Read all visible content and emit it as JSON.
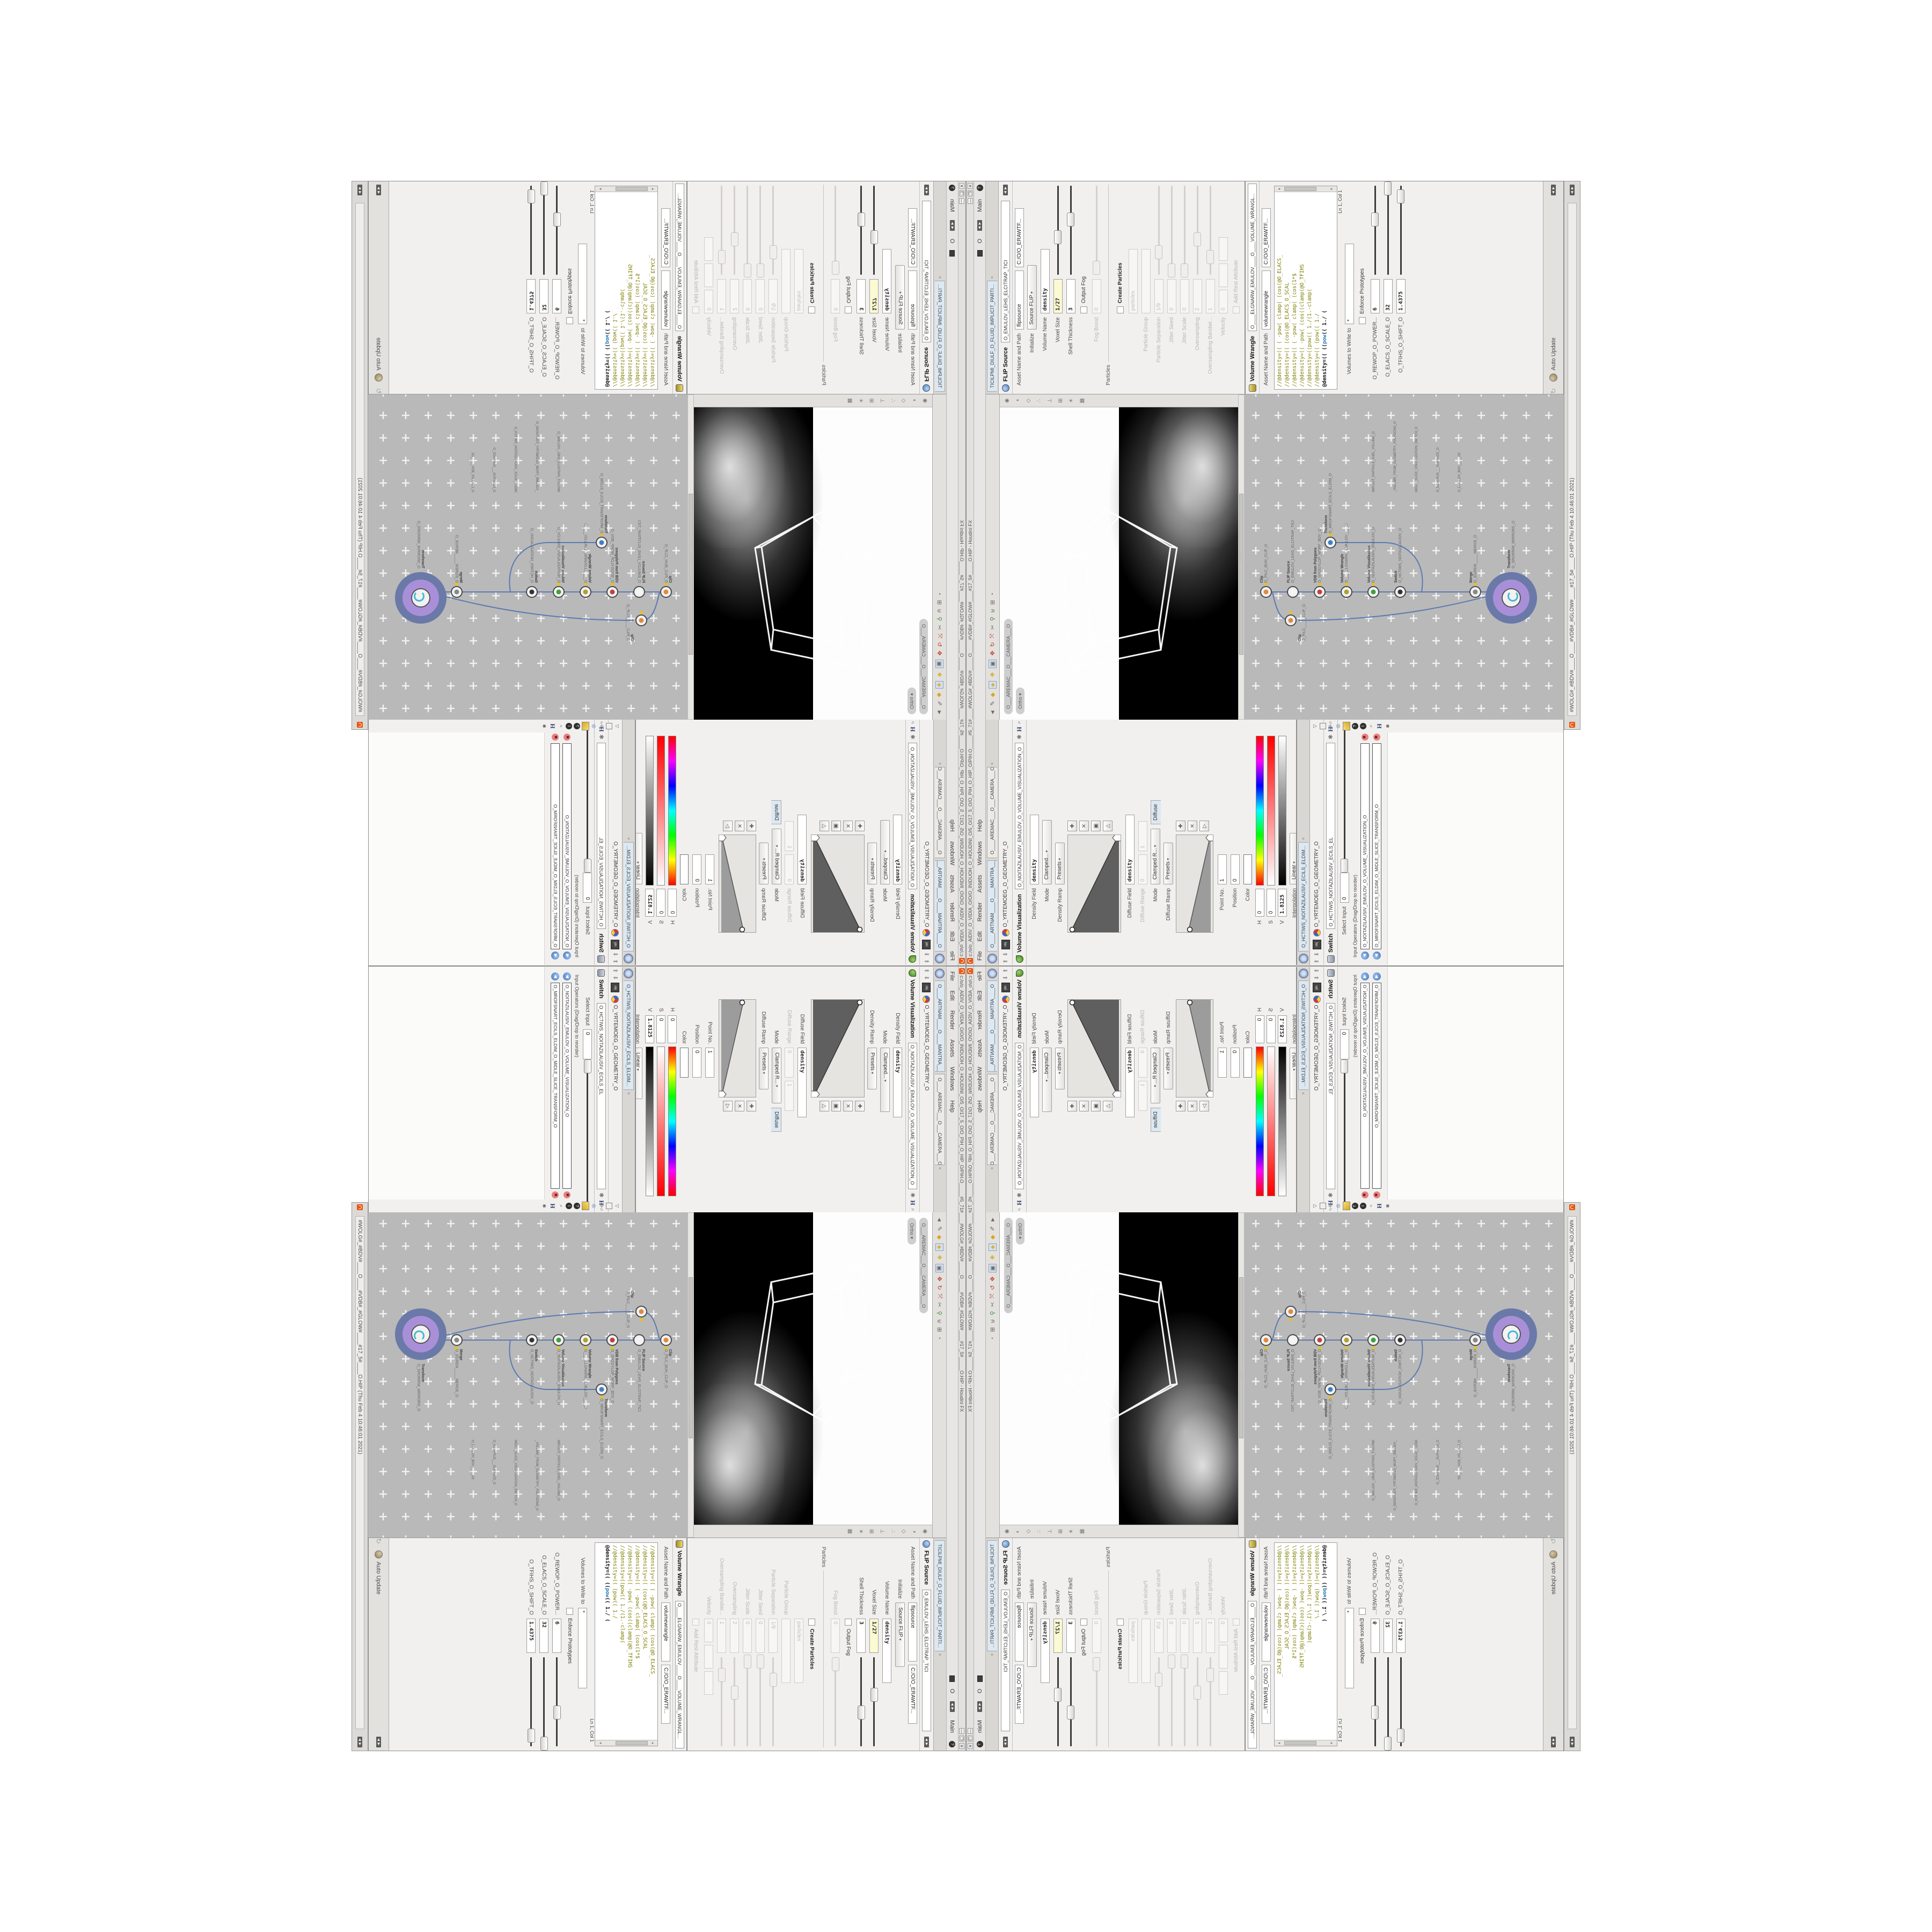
{
  "window": {
    "title": "c:/o/o_AIDIV_O_VIDIA_O/O/O_INIDUOH_O_HOUDINI_O/5_O/17_5_O/O_PIH_O_HIP_O/PIH.O_____#5_71#____#WOLG#_#BDV#_____O_____#VDB#_#GLOW#____#17_5#_____O.HIP - Houdini FX",
    "title2": "#WOLG#_#BDV#____O____#VDB#_#GLOW#____#17_5#____O.HIP (Thu Feb 4 10:46:01 2021)",
    "btn_min": "—",
    "btn_restore": "❐",
    "btn_close": "✕",
    "logo_color": "#e8540c"
  },
  "menu": {
    "items": [
      "File",
      "Edit",
      "Render",
      "Assets",
      "Windows",
      "Help"
    ],
    "extra_o": "O",
    "desktop": "Main",
    "help_badge": "?"
  },
  "viz_pane": {
    "tab1": "O____ARTNAM____O____MANTRA____O",
    "tab2": "O____AREMAC___O___CAMERA___O",
    "path_context": "obj",
    "path": "O_YRTEMOEG_O_GEOMETRY_O",
    "title": "Volume Visualization",
    "asset": "O_NOITAZILAUSIV_EMULOV_O_VOLUME_VISUALIZATION_O",
    "density_field_label": "Density Field",
    "density_field_value": "density",
    "mode_label": "Mode",
    "mode_value": "Clamped...",
    "density_ramp_label": "Density Ramp",
    "presets_label": "Presets",
    "diffuse_field_label": "Diffuse Field",
    "diffuse_field_value": "density",
    "diffuse_range_label": "Diffuse Range",
    "diffuse_range_min": "0",
    "diffuse_range_max": "1",
    "mode2_label": "Mode",
    "mode2_value": "Clamped R...",
    "diffuse_tab": "Diffuse",
    "diffuse_ramp_label": "Diffuse Ramp",
    "point_label": "Point No.",
    "point_value": "1",
    "position_label": "Position",
    "position_value": "0",
    "color_label": "Color",
    "h_label": "H",
    "h_value": "0",
    "s_label": "S",
    "s_value": "0",
    "v_label": "V",
    "v_value": "1.8125",
    "interp_label": "Interpolation",
    "interp_value": "Linear"
  },
  "switch_pane": {
    "tab": "O_HCTIWS_NOITAZILAUSIV_ECILS_ELDIM...",
    "path_context": "obj",
    "path": "O_YRTEMOEG_O_GEOMETRY_O",
    "title": "Switch",
    "asset": "O_HCTIWS_NOITAZILAUSIV_ECILS_EL",
    "select_label": "Select Input",
    "select_value": "0",
    "inputs_label": "Input Operators (Drag/Drop to reorder)",
    "items": [
      "O_NOITAZILAUSIV_EMULOV_O_VOLUME_VISUALIZATION_O",
      "O_MROFSNART_ECILS_ELDIM_O_MIDLE_SLICE_TRANSFORM_O"
    ]
  },
  "viewport": {
    "camera_pill": "O___AREMAC___O___CAMERA___O",
    "projection_pill": "Ortho"
  },
  "network": {
    "bg_color": "#b9b9b9",
    "wire_color": "#5b79b2",
    "badge_outer_color": "#6a79a8",
    "badge_inner_color": "#a98fd8",
    "nodes": [
      {
        "type": "Clip",
        "name": "O_PILC_BUH_CLIP_O"
      },
      {
        "type": "Clip",
        "name": "O_PILC_____CLIP_O"
      },
      {
        "type": "FLIP Source",
        "name": "O_EMULOV_LEHS_ELCITRAP_TICI"
      },
      {
        "type": "VDB from Polygons",
        "name": "O_SNOGYLOP_MORF_BDV_O"
      },
      {
        "type": "Volume Wrangle",
        "name": "O____ELGNARW_EMULOV____O"
      },
      {
        "type": "Volume Visualization",
        "name": "O_NOITAZILAUSIV_EMULOV_O"
      },
      {
        "type": "Transform",
        "name": "O_MROFSNART_ECILS_ELDIM_O"
      },
      {
        "type": "Switch",
        "name": "O_HCTIWS_NOITAZILAUSIV_O"
      },
      {
        "type": "Merge",
        "name": "O_EGREM_____MERGE_O"
      },
      {
        "type": "Transform",
        "name": "O_SRORRIM_MIRRORS_O"
      }
    ],
    "bg_labels": [
      "IMPLICIT_PARTICLE_SHEL_VOLUME_O",
      "_VOLUME_FROM_GEOMETRY_POLYGONS_O",
      "MIDLE_SLICE_VISUALIZATION_SWITCH_O",
      "O_ECAFRUS___SURFACE_O",
      "O_EMULOV_BDV_____O2"
    ]
  },
  "flip_pane": {
    "tab": "TICILPMI_DIULF_O_FLUID_IMPLICIT_PARTI...",
    "title": "FLIP Source",
    "asset": "O_EMULOV_LEHS_ELCITRAP_TICI",
    "asset_label": "Asset Name and Path",
    "name": "flipsource",
    "software": "C:/O/O_ERAWTF...",
    "init_label": "Initialize",
    "init_value": "Source FLIP",
    "rows": [
      {
        "label": "Volume Name",
        "value": "density"
      },
      {
        "label": "Voxel Size",
        "value": "1/27"
      },
      {
        "label": "Shell Thickness",
        "value": "3"
      },
      {
        "label": "Output Fog",
        "value": ""
      },
      {
        "label": "Fog Boost",
        "value": "0"
      },
      {
        "label": "Particles",
        "value": ""
      },
      {
        "label": "Create Particles",
        "value": ""
      },
      {
        "label": "",
        "value": "particles"
      },
      {
        "label": "Particle Group",
        "value": ""
      },
      {
        "label": "Particle Separation",
        "value": "1/9"
      },
      {
        "label": "Jitter Seed",
        "value": "0"
      },
      {
        "label": "Jitter Scale",
        "value": "0"
      },
      {
        "label": "Oversampling",
        "value": "2"
      },
      {
        "label": "Oversampling Bandwi...",
        "value": "1"
      },
      {
        "label": "Velocity",
        "value": "0"
      },
      {
        "label": "Add Rest Attribute",
        "value": ""
      }
    ]
  },
  "wrangle_pane": {
    "title": "Volume Wrangle",
    "asset": "O____ELGNARW_EMULOV____O____VOLUME_WRANGL...",
    "asset_label": "Asset Name and Path",
    "name": "volumewrangle",
    "software": "C:/O/O_ERAWTF...",
    "code": [
      "//@density=((  ( -pow( clamp(  (cos(@O_ELACS_",
      "//@density=((        (cos(@O_ELACS_O_SCAL",
      "//@density=((  ( -pow( clamp(  (cos(1*$",
      "//@density=((     -pow(  (cos((clamp(@O_TFIHS",
      "//@density=((pow((   1./(1.-clamp(",
      "//@density=((        (pow((       1./"
    ],
    "active_prefix": "@density=((   ((",
    "active_keyword": "pow",
    "active_suffix": "((   1./ (",
    "status": "Ln 1, Col 1"
  },
  "output_pane": {
    "volumes_label": "Volumes to Write to",
    "volumes_value": "*",
    "enforce_label": "Enforce Prototypes",
    "sliders": [
      {
        "label": "O_REWOP_O_POWER...",
        "value": "6",
        "pos": 62
      },
      {
        "label": "O_ELACS_O_SCALE_O",
        "value": "32",
        "pos": 97
      },
      {
        "label": "O_TFIHS_O_SHIFT_O",
        "value": "1.4375",
        "pos": 88
      }
    ],
    "auto_update": "Auto Update"
  }
}
